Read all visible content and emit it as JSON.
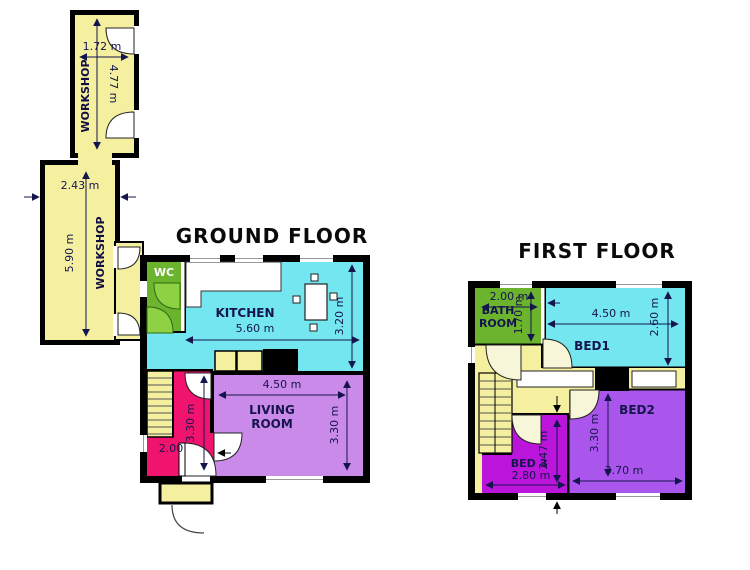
{
  "workshops": {
    "top_label": "WORKSHOP",
    "top_width": "1.72 m",
    "top_height": "4.77 m",
    "main_label": "WORKSHOP",
    "main_width": "2.43 m",
    "main_height": "5.90 m"
  },
  "ground_floor": {
    "title": "GROUND FLOOR",
    "wc_label": "WC",
    "kitchen_label": "KITCHEN",
    "kitchen_width": "5.60 m",
    "kitchen_height": "3.20 m",
    "living_label_1": "LIVING",
    "living_label_2": "ROOM",
    "living_width": "4.50 m",
    "living_height": "3.30 m",
    "hall_width": "2.00",
    "hall_height": "3.30 m"
  },
  "first_floor": {
    "title": "FIRST FLOOR",
    "bathroom_label_1": "BATH",
    "bathroom_label_2": "ROOM",
    "bathroom_width": "2.00 m",
    "bathroom_height": "1.70 m",
    "bed1_label": "BED1",
    "bed1_width": "4.50 m",
    "bed1_height": "2.60 m",
    "bed2_label": "BED2",
    "bed2_width": "3.70 m",
    "bed2_height": "3.30 m",
    "bed3_label": "BED 3",
    "bed3_width": "2.80 m",
    "bed3_height": "2.47 m"
  },
  "colors": {
    "wall": "#000000",
    "workshop_fill": "#f4f0a0",
    "kitchen_fill": "#73e6f0",
    "wc_fill": "#6cb32e",
    "wc_door_fill": "#8ed244",
    "living_fill": "#ca8ae9",
    "hall_fill": "#f0146e",
    "bed2_fill": "#aa55ec",
    "bed3_fill": "#bb14da",
    "dim_text": "#15154d"
  }
}
